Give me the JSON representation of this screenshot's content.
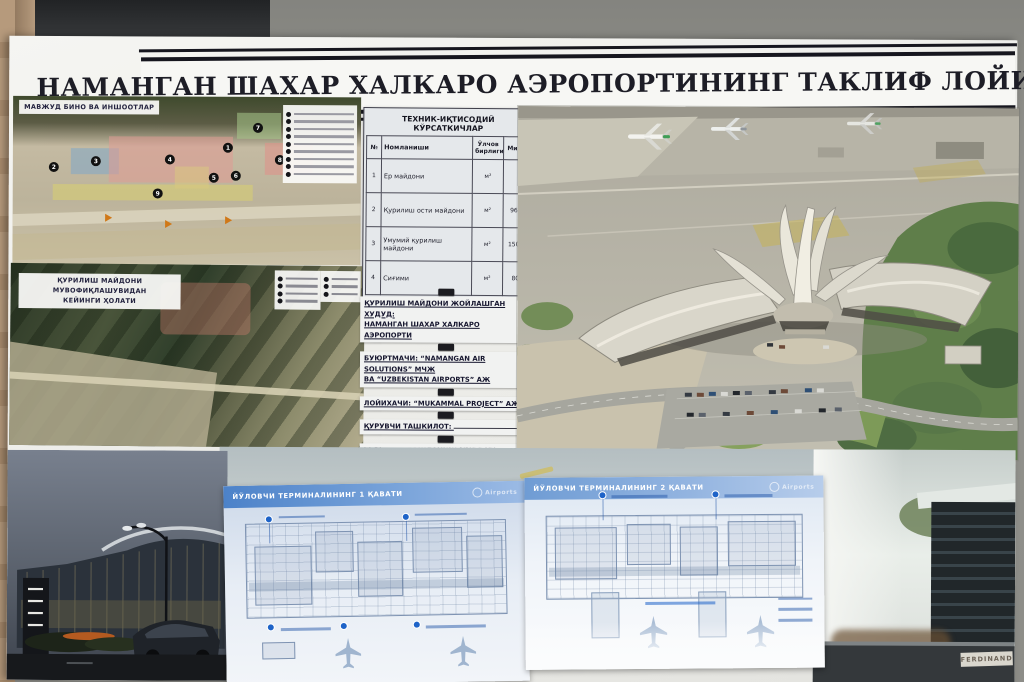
{
  "poster": {
    "title": "НАМАНГАН ШАХАР ХАЛКАРО АЭРОПОРТИНИНГ ТАКЛИФ ЛОЙИХАСИ",
    "map_existing": {
      "title": "МАВЖУД БИНО ВА ИНШООТЛАР",
      "markers": [
        "1",
        "2",
        "3",
        "4",
        "5",
        "6",
        "7",
        "8",
        "9"
      ]
    },
    "map_after": {
      "title_line1": "ҚУРИЛИШ МАЙДОНИ МУВОФИҚЛАШУВИДАН",
      "title_line2": "КЕЙИНГИ ҲОЛАТИ"
    },
    "table": {
      "title": "ТЕХНИК-ИҚТИСОДИЙ КЎРСАТКИЧЛАР",
      "columns": [
        "№",
        "Номланиши",
        "Ўлчов бирлиги",
        "Миқдор"
      ],
      "rows": [
        {
          "no": "1",
          "name": "Ер майдони",
          "unit": "м²",
          "value": ""
        },
        {
          "no": "2",
          "name": "Қурилиш ости майдони",
          "unit": "м²",
          "value": "9600.0"
        },
        {
          "no": "3",
          "name": "Умумий қурилиш майдони",
          "unit": "м²",
          "value": "15000.0"
        },
        {
          "no": "4",
          "name": "Сиғими",
          "unit": "м²",
          "value": "800.0"
        }
      ]
    },
    "info": {
      "line1a": "ҚУРИЛИШ МАЙДОНИ ЖОЙЛАШГАН ХУДУД:",
      "line1b": "НАМАНГАН ШАХАР ХАЛКАРО АЭРОПОРТИ",
      "line2a": "БУЮРТМАЧИ: “NAMANGAN AIR SOLUTIONS” МЧЖ",
      "line2b": "ВА “UZBEKISTAN AIRPORTS” АЖ",
      "line3": "ЛОЙИХАЧИ: “MUKAMMAL PROJECT” АЖ",
      "line4": "ҚУРУВЧИ ТАШКИЛОТ:",
      "line5": "ҚУРИЛИШ БОШЛАНИШ МУДДАТИ: 2024 ЙИЛ",
      "line6": "БИНОНИ ИШГА ТУШИРИШ МУДДАТИ: 2026 ЙИЛ"
    },
    "plans": {
      "left_title": "ЙЎЛОВЧИ ТЕРМИНАЛИНИНГ 1 ҚАВАТИ",
      "right_title": "ЙЎЛОВЧИ ТЕРМИНАЛИНИНГ 2 ҚАВАТИ",
      "logo": "Airports"
    },
    "photos": {
      "right_label": "FERDINAND"
    }
  }
}
